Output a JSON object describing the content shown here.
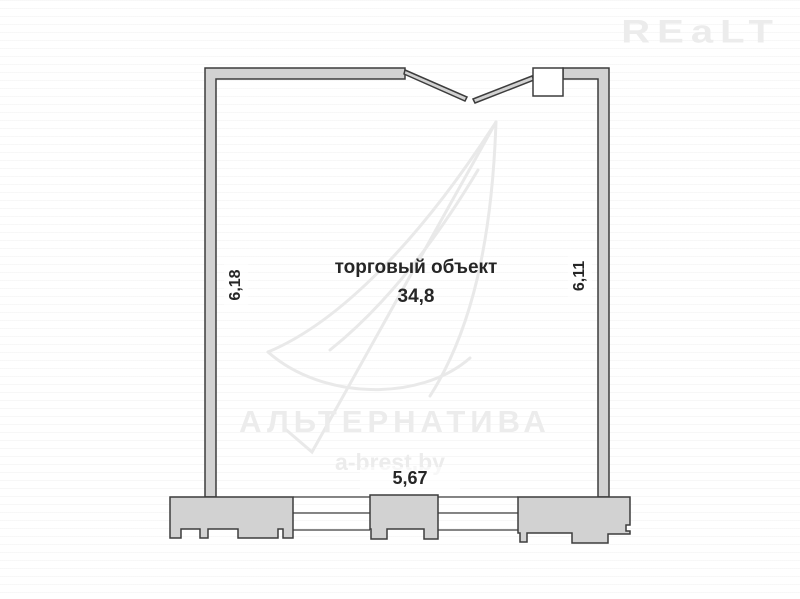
{
  "branding": {
    "realt_logo": "REaLT",
    "watermark_name": "АЛЬТЕРНАТИВА",
    "watermark_site": "a-brest.by"
  },
  "floor_plan": {
    "room_label": "торговый объект",
    "room_area": "34,8",
    "dimensions": {
      "left": "6,18",
      "right": "6,11",
      "bottom": "5,67"
    },
    "colors": {
      "wall_fill": "#d2d2d2",
      "wall_outline": "#3d3d3d",
      "watermark_gray": "#ececec",
      "label_text": "#262626",
      "background": "#ffffff"
    }
  }
}
